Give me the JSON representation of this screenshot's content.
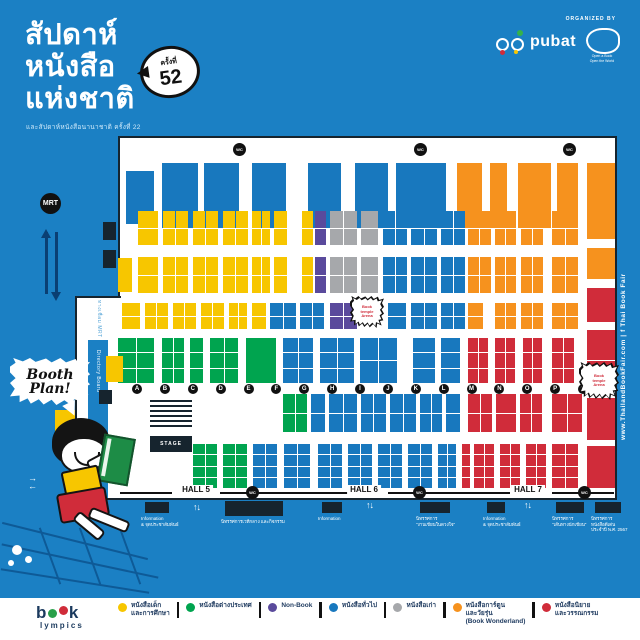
{
  "colors": {
    "Y": "#f7c600",
    "B": "#1878be",
    "G": "#00a44f",
    "P": "#5a4a9c",
    "GR": "#a6a8ab",
    "O": "#f6921e",
    "R": "#d02c3a",
    "bg": "#1b80c4",
    "ink": "#16242e"
  },
  "header": {
    "title_lines": [
      "สัปดาห์",
      "หนังสือ",
      "แห่งชาติ"
    ],
    "badge_label": "ครั้งที่",
    "badge_number": "52",
    "subtitle": "และสัปดาห์หนังสือนานาชาติ ครั้งที่ 22",
    "organized_by": "ORGANIZED BY",
    "pubat": "pubat",
    "org2_line1": "Open a Book",
    "org2_line2": "Open the World"
  },
  "side": {
    "mrt": "MRT",
    "website_full": "www.ThailandBookFair.com  |  f Thai Book Fair",
    "corridor": "ทางเชื่อม MRT",
    "directory": "Directory Board"
  },
  "bubble": {
    "line1": "Booth",
    "line2": "Plan!"
  },
  "map": {
    "stage": "STAGE",
    "wc": "WC",
    "arena": "Book temple Arena",
    "halls": [
      {
        "label": "HALL 5",
        "x": 196
      },
      {
        "label": "HALL 6",
        "x": 364
      },
      {
        "label": "HALL 7",
        "x": 528
      }
    ],
    "hall_lines": [
      [
        120,
        52
      ],
      [
        220,
        128
      ],
      [
        388,
        122
      ],
      [
        552,
        62
      ]
    ],
    "letters": [
      "A",
      "B",
      "C",
      "D",
      "E",
      "F",
      "G",
      "H",
      "I",
      "J",
      "K",
      "L",
      "M",
      "N",
      "O",
      "P",
      "Q"
    ],
    "letters_x0": 132,
    "letters_step": 27.875,
    "letters_y": 384,
    "toilets": [
      [
        233,
        143
      ],
      [
        414,
        143
      ],
      [
        563,
        143
      ],
      [
        246,
        486
      ],
      [
        413,
        486
      ],
      [
        578,
        486
      ]
    ],
    "arrows_v": [
      [
        193,
        502
      ],
      [
        366,
        500
      ],
      [
        524,
        500
      ],
      [
        90,
        298
      ]
    ],
    "arrows_h": [
      [
        28,
        474
      ]
    ],
    "black_boxes": [
      [
        103,
        222,
        13,
        18
      ],
      [
        103,
        250,
        13,
        18
      ],
      [
        99,
        390,
        13,
        14
      ]
    ],
    "badges": [
      {
        "x": 350,
        "y": 296,
        "w": 34,
        "h": 32
      },
      {
        "x": 579,
        "y": 362,
        "w": 40,
        "h": 38
      }
    ],
    "captions": [
      {
        "box": [
          145,
          502,
          24,
          11
        ],
        "lines": [
          "Information",
          "& จุดประชาสัมพันธ์"
        ]
      },
      {
        "box": [
          225,
          501,
          58,
          15
        ],
        "lines": [
          "นิทรรศการเวทีกลาง และกิจกรรม"
        ]
      },
      {
        "box": [
          322,
          502,
          20,
          11
        ],
        "lines": [
          "Information"
        ]
      },
      {
        "box": [
          420,
          502,
          30,
          11
        ],
        "lines": [
          "นิทรรศการ",
          "\"งานเขียนในดวงใจ\""
        ]
      },
      {
        "box": [
          487,
          502,
          18,
          11
        ],
        "lines": [
          "Information",
          "& จุดประชาสัมพันธ์"
        ]
      },
      {
        "box": [
          556,
          502,
          28,
          11
        ],
        "lines": [
          "นิทรรศการ",
          "\"เส้นทางนักเขียน\""
        ]
      },
      {
        "box": [
          595,
          502,
          26,
          11
        ],
        "lines": [
          "นิทรรศการ",
          "หนังสือดีเด่น",
          "ประจำปี พ.ศ. 2567"
        ]
      }
    ],
    "booths": [
      [
        "B",
        126,
        171,
        28,
        53,
        1,
        1
      ],
      [
        "B",
        162,
        163,
        36,
        65,
        1,
        1
      ],
      [
        "B",
        204,
        163,
        35,
        65,
        1,
        1
      ],
      [
        "B",
        252,
        163,
        34,
        65,
        1,
        1
      ],
      [
        "B",
        308,
        163,
        33,
        65,
        1,
        1
      ],
      [
        "B",
        355,
        163,
        33,
        65,
        1,
        1
      ],
      [
        "B",
        396,
        163,
        50,
        65,
        1,
        1
      ],
      [
        "O",
        457,
        163,
        25,
        65,
        1,
        1
      ],
      [
        "O",
        490,
        163,
        17,
        65,
        1,
        1
      ],
      [
        "O",
        518,
        163,
        33,
        65,
        1,
        1
      ],
      [
        "O",
        557,
        163,
        21,
        65,
        1,
        1
      ],
      [
        "O",
        587,
        163,
        28,
        76,
        1,
        1
      ],
      [
        "Y",
        138,
        211,
        20,
        34,
        1,
        2
      ],
      [
        "Y",
        163,
        211,
        25,
        34,
        2,
        2
      ],
      [
        "Y",
        193,
        211,
        25,
        34,
        2,
        2
      ],
      [
        "Y",
        223,
        211,
        25,
        34,
        2,
        2
      ],
      [
        "Y",
        252,
        211,
        18,
        34,
        2,
        2
      ],
      [
        "Y",
        274,
        211,
        13,
        34,
        1,
        2
      ],
      [
        "Y",
        302,
        211,
        11,
        34,
        1,
        2
      ],
      [
        "P",
        315,
        211,
        11,
        34,
        1,
        2
      ],
      [
        "GR",
        330,
        211,
        27,
        34,
        2,
        2
      ],
      [
        "GR",
        361,
        211,
        17,
        34,
        1,
        2
      ],
      [
        "B",
        383,
        211,
        24,
        34,
        2,
        2
      ],
      [
        "B",
        411,
        211,
        26,
        34,
        2,
        2
      ],
      [
        "B",
        441,
        211,
        24,
        34,
        2,
        2
      ],
      [
        "O",
        468,
        211,
        23,
        34,
        2,
        2
      ],
      [
        "O",
        495,
        211,
        21,
        34,
        2,
        2
      ],
      [
        "O",
        521,
        211,
        22,
        34,
        2,
        2
      ],
      [
        "O",
        552,
        211,
        26,
        34,
        2,
        2
      ],
      [
        "Y",
        118,
        258,
        14,
        34,
        1,
        1
      ],
      [
        "Y",
        138,
        257,
        20,
        36,
        1,
        2
      ],
      [
        "Y",
        163,
        257,
        25,
        36,
        2,
        2
      ],
      [
        "Y",
        193,
        257,
        25,
        36,
        2,
        2
      ],
      [
        "Y",
        223,
        257,
        25,
        36,
        2,
        2
      ],
      [
        "Y",
        252,
        257,
        18,
        36,
        2,
        2
      ],
      [
        "Y",
        274,
        257,
        13,
        36,
        1,
        2
      ],
      [
        "Y",
        302,
        257,
        11,
        36,
        1,
        2
      ],
      [
        "P",
        315,
        257,
        11,
        36,
        1,
        2
      ],
      [
        "GR",
        330,
        257,
        27,
        36,
        2,
        2
      ],
      [
        "GR",
        361,
        257,
        17,
        36,
        1,
        2
      ],
      [
        "B",
        383,
        257,
        24,
        36,
        2,
        2
      ],
      [
        "B",
        411,
        257,
        26,
        36,
        2,
        2
      ],
      [
        "B",
        441,
        257,
        24,
        36,
        2,
        2
      ],
      [
        "O",
        468,
        257,
        23,
        36,
        2,
        2
      ],
      [
        "O",
        495,
        257,
        21,
        36,
        2,
        2
      ],
      [
        "O",
        521,
        257,
        22,
        36,
        2,
        2
      ],
      [
        "O",
        552,
        257,
        26,
        36,
        2,
        2
      ],
      [
        "O",
        587,
        248,
        28,
        31,
        1,
        1
      ],
      [
        "Y",
        122,
        303,
        18,
        26,
        1,
        2
      ],
      [
        "Y",
        145,
        303,
        23,
        26,
        2,
        2
      ],
      [
        "Y",
        173,
        303,
        23,
        26,
        2,
        2
      ],
      [
        "Y",
        201,
        303,
        23,
        26,
        2,
        2
      ],
      [
        "Y",
        229,
        303,
        18,
        26,
        2,
        2
      ],
      [
        "Y",
        252,
        303,
        14,
        26,
        1,
        2
      ],
      [
        "B",
        270,
        303,
        26,
        26,
        2,
        2
      ],
      [
        "B",
        300,
        303,
        24,
        26,
        2,
        2
      ],
      [
        "P",
        330,
        303,
        27,
        26,
        2,
        2
      ],
      [
        "B",
        388,
        303,
        18,
        26,
        1,
        2
      ],
      [
        "B",
        411,
        303,
        26,
        26,
        2,
        2
      ],
      [
        "B",
        441,
        303,
        24,
        26,
        2,
        2
      ],
      [
        "O",
        468,
        303,
        15,
        26,
        1,
        2
      ],
      [
        "O",
        495,
        303,
        21,
        26,
        2,
        2
      ],
      [
        "O",
        521,
        303,
        22,
        26,
        2,
        2
      ],
      [
        "O",
        552,
        303,
        26,
        26,
        2,
        2
      ],
      [
        "R",
        587,
        288,
        28,
        34,
        1,
        1
      ],
      [
        "G",
        118,
        338,
        36,
        45,
        2,
        3
      ],
      [
        "G",
        162,
        338,
        22,
        45,
        2,
        3
      ],
      [
        "G",
        190,
        338,
        13,
        45,
        1,
        3
      ],
      [
        "G",
        210,
        338,
        28,
        45,
        2,
        3
      ],
      [
        "G",
        246,
        338,
        30,
        45,
        1,
        1
      ],
      [
        "B",
        283,
        338,
        30,
        45,
        2,
        3
      ],
      [
        "B",
        320,
        338,
        34,
        45,
        2,
        3
      ],
      [
        "B",
        360,
        338,
        37,
        45,
        2,
        2
      ],
      [
        "B",
        413,
        338,
        22,
        45,
        1,
        3
      ],
      [
        "B",
        441,
        338,
        19,
        45,
        1,
        3
      ],
      [
        "R",
        468,
        338,
        20,
        45,
        2,
        3
      ],
      [
        "R",
        495,
        338,
        20,
        45,
        2,
        3
      ],
      [
        "R",
        523,
        338,
        19,
        45,
        2,
        3
      ],
      [
        "R",
        552,
        338,
        22,
        45,
        2,
        3
      ],
      [
        "R",
        587,
        330,
        28,
        60,
        1,
        2
      ],
      [
        "G",
        283,
        394,
        24,
        38,
        2,
        2
      ],
      [
        "B",
        311,
        394,
        14,
        38,
        1,
        2
      ],
      [
        "B",
        329,
        394,
        28,
        38,
        2,
        2
      ],
      [
        "B",
        361,
        394,
        25,
        38,
        2,
        2
      ],
      [
        "B",
        390,
        394,
        26,
        38,
        2,
        2
      ],
      [
        "B",
        420,
        394,
        22,
        38,
        2,
        2
      ],
      [
        "B",
        446,
        394,
        14,
        38,
        1,
        2
      ],
      [
        "R",
        468,
        394,
        24,
        38,
        2,
        2
      ],
      [
        "R",
        496,
        394,
        20,
        38,
        1,
        2
      ],
      [
        "R",
        520,
        394,
        22,
        38,
        2,
        2
      ],
      [
        "R",
        552,
        394,
        30,
        38,
        2,
        2
      ],
      [
        "R",
        587,
        398,
        28,
        42,
        1,
        1
      ],
      [
        "G",
        193,
        444,
        24,
        44,
        2,
        4
      ],
      [
        "G",
        223,
        444,
        24,
        44,
        2,
        4
      ],
      [
        "B",
        253,
        444,
        24,
        44,
        2,
        4
      ],
      [
        "B",
        284,
        444,
        26,
        44,
        2,
        4
      ],
      [
        "B",
        318,
        444,
        24,
        44,
        2,
        4
      ],
      [
        "B",
        348,
        444,
        24,
        44,
        2,
        4
      ],
      [
        "B",
        378,
        444,
        24,
        44,
        2,
        4
      ],
      [
        "B",
        408,
        444,
        24,
        44,
        2,
        4
      ],
      [
        "B",
        438,
        444,
        18,
        44,
        2,
        4
      ],
      [
        "R",
        462,
        444,
        8,
        44,
        1,
        4
      ],
      [
        "R",
        474,
        444,
        20,
        44,
        2,
        4
      ],
      [
        "R",
        500,
        444,
        20,
        44,
        2,
        4
      ],
      [
        "R",
        526,
        444,
        20,
        44,
        2,
        4
      ],
      [
        "R",
        552,
        444,
        26,
        44,
        2,
        4
      ],
      [
        "R",
        587,
        446,
        28,
        42,
        1,
        1
      ],
      [
        "Y",
        55,
        410,
        20,
        28,
        1,
        1
      ],
      [
        "Y",
        106,
        356,
        17,
        26,
        1,
        1
      ]
    ]
  },
  "legend": {
    "items": [
      {
        "c": "Y",
        "lines": [
          "หนังสือเด็ก",
          "และการศึกษา"
        ]
      },
      {
        "c": "G",
        "lines": [
          "หนังสือต่างประเทศ"
        ]
      },
      {
        "c": "P",
        "lines": [
          "Non-Book"
        ]
      },
      {
        "c": "B",
        "lines": [
          "หนังสือทั่วไป"
        ]
      },
      {
        "c": "GR",
        "lines": [
          "หนังสือเก่า"
        ]
      },
      {
        "c": "O",
        "lines": [
          "หนังสือการ์ตูน",
          "และวัยรุ่น",
          "(Book Wonderland)"
        ]
      },
      {
        "c": "R",
        "lines": [
          "หนังสือนิยาย",
          "และวรรณกรรม"
        ]
      }
    ]
  },
  "footer_logo": {
    "b": "b",
    "k": "k",
    "lympics": "lympics"
  }
}
